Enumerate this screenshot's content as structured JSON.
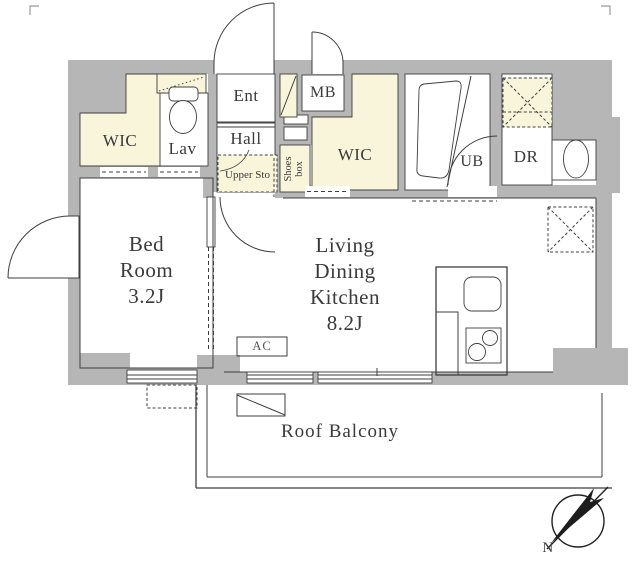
{
  "colors": {
    "wall": "#b6b6b6",
    "accent_cream": "#f9f5da",
    "line": "#3f3f3f",
    "background": "#ffffff"
  },
  "rooms": {
    "wic1": "WIC",
    "lav": "Lav",
    "ent": "Ent",
    "hall": "Hall",
    "upper_storage": "Upper Sto",
    "shoes_line1": "Shoes",
    "shoes_line2": "box",
    "mb": "MB",
    "wic2": "WIC",
    "ub": "UB",
    "dr": "DR",
    "bedroom": {
      "line1": "Bed",
      "line2": "Room",
      "size": "3.2J"
    },
    "ldk": {
      "line1": "Living",
      "line2": "Dining",
      "line3": "Kitchen",
      "size": "8.2J"
    },
    "balcony": "Roof Balcony",
    "ac_unit": "AC",
    "compass_north": "N"
  }
}
